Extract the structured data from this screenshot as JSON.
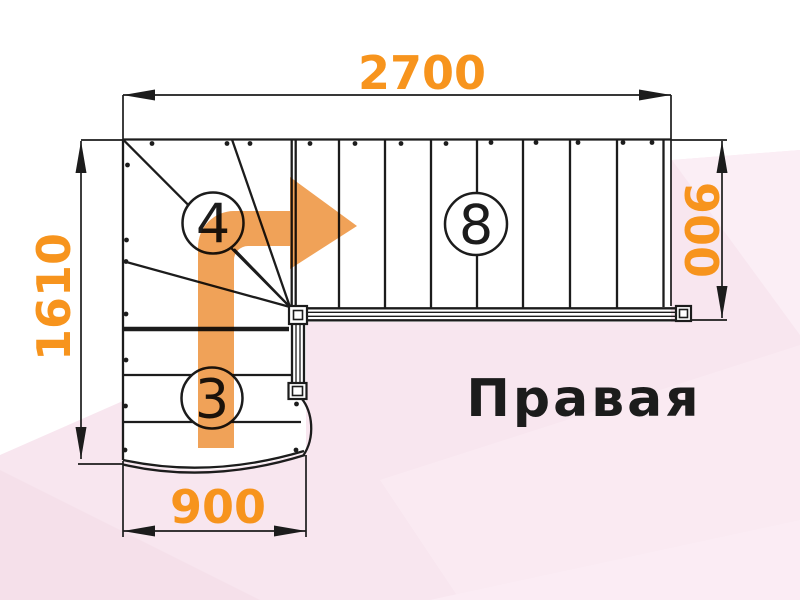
{
  "title": {
    "text": "Правая"
  },
  "dimensions": {
    "width_top": "2700",
    "height_left": "1610",
    "height_right": "900",
    "width_bottom": "900"
  },
  "steps": {
    "winder_flight": "4",
    "upper_flight": "8",
    "lower_flight": "3"
  },
  "colors": {
    "dimension_text": "#f7941d",
    "arrow": "#f0a258",
    "linework": "#1c1c1c",
    "background_pink": "#f8e6ef",
    "background_pink_light": "#fbeef5",
    "background_pink_dark": "#f5e0ea"
  }
}
